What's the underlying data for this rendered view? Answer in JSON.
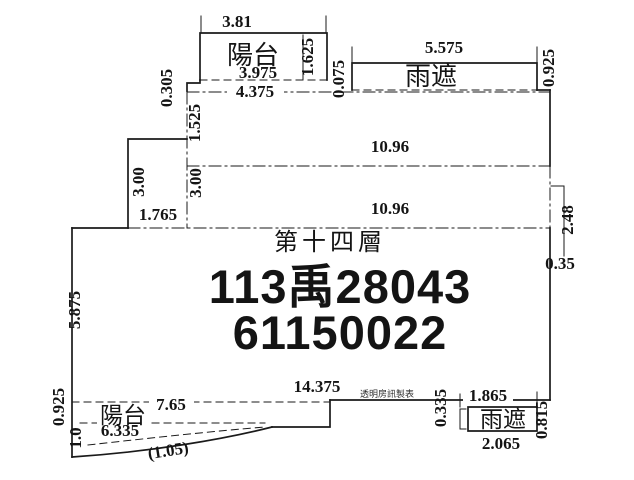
{
  "colors": {
    "ink": "#1a1a1a",
    "paper": "#ffffff",
    "watermark": "#2e2e2e"
  },
  "plan": {
    "floor_label": "第十四層",
    "case_number": "113禹28043",
    "serial_number": "61150022",
    "watermark": "透明房訊製表",
    "top_balcony": {
      "label": "陽台",
      "dims": {
        "top_width": "3.81",
        "inner_width": "3.975",
        "height": "1.625",
        "lower_width": "4.375",
        "left_offset": "0.305",
        "right_offset": "0.075",
        "depth_below": "1.525"
      }
    },
    "top_canopy": {
      "label": "雨遮",
      "dims": {
        "width": "5.575",
        "height": "0.925"
      }
    },
    "main": {
      "dims": {
        "upper_width": "10.96",
        "lower_width": "10.96",
        "left_step_outer_height": "3.00",
        "left_step_inner_height": "3.00",
        "left_step_width": "1.765",
        "right_upper_height": "2.48",
        "right_offset": "0.35",
        "left_height": "5.875",
        "bottom_width": "14.375"
      }
    },
    "bottom_balcony": {
      "label": "陽台",
      "dims": {
        "left_height": "0.925",
        "top_width": "7.65",
        "left_lower_height": "1.0",
        "lower_width": "6.335",
        "curve_depth": "(1.05)"
      }
    },
    "bottom_canopy": {
      "label": "雨遮",
      "dims": {
        "left_offset": "0.335",
        "top_width": "1.865",
        "height": "0.815",
        "bottom_width": "2.065"
      }
    }
  }
}
